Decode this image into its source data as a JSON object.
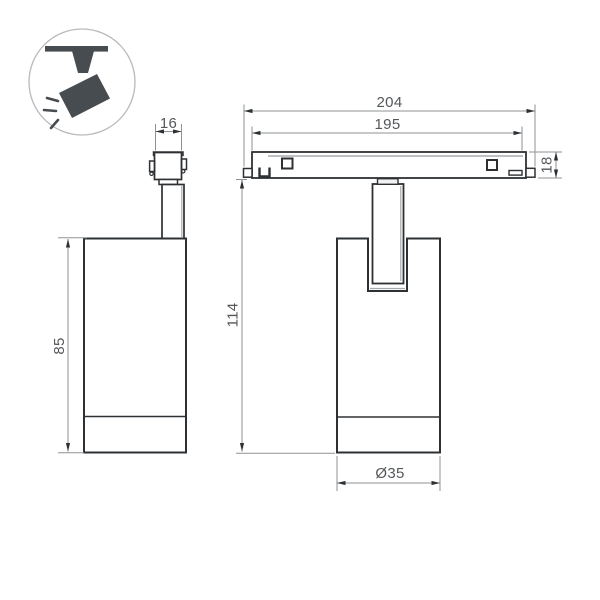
{
  "colors": {
    "line": "#2e3134",
    "dim": "#8f9294",
    "text": "#54575a",
    "icon": "#474c51",
    "badge-border": "#b7b9bb"
  },
  "icons": {
    "badge": "track-spotlight-icon"
  },
  "dimensions": {
    "adapter_width": "16",
    "body_height": "85",
    "track_length_outer": "204",
    "track_length_inner": "195",
    "track_height": "18",
    "overall_height": "114",
    "head_diameter": "Ø35"
  }
}
